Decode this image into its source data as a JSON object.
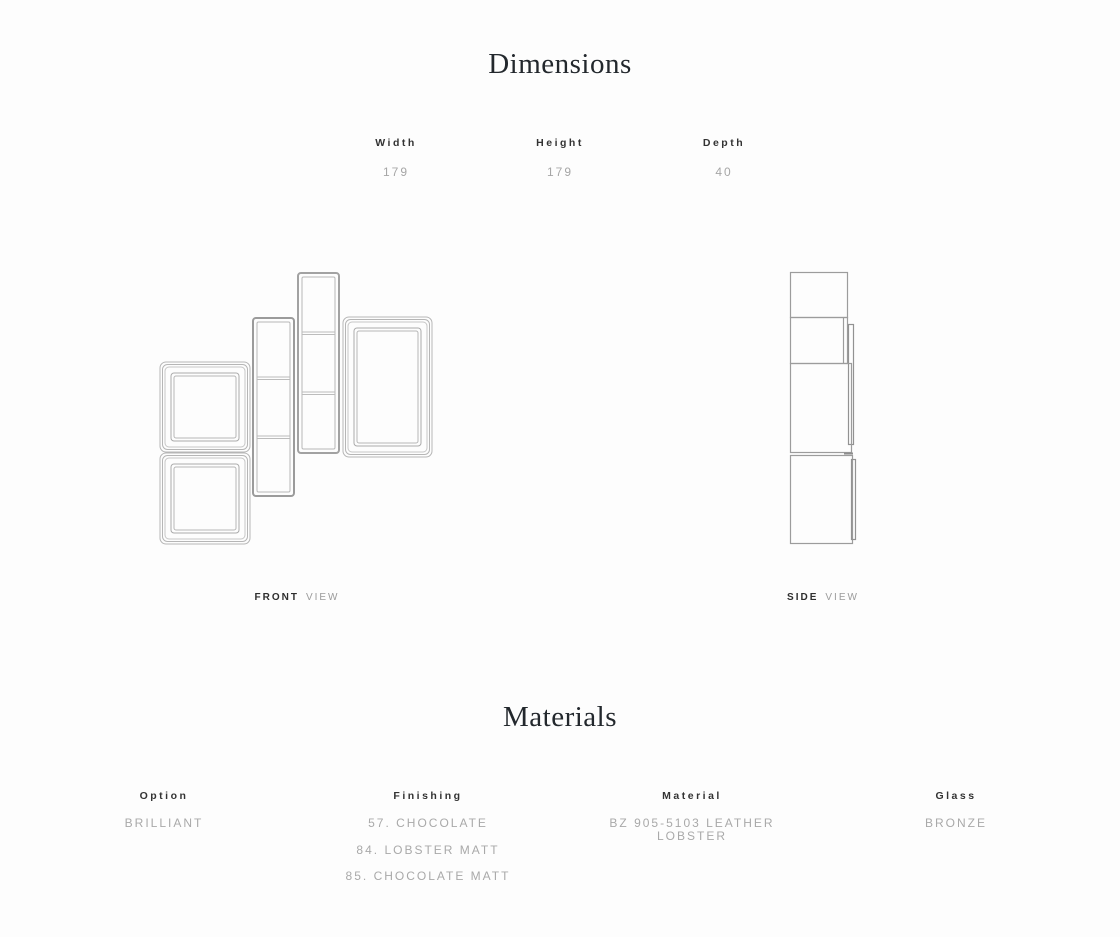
{
  "dimensions_section": {
    "title": "Dimensions",
    "columns": [
      {
        "label": "Width",
        "value": "179"
      },
      {
        "label": "Height",
        "value": "179"
      },
      {
        "label": "Depth",
        "value": "40"
      }
    ],
    "front_view": {
      "label_bold": "FRONT",
      "label_light": "VIEW"
    },
    "side_view": {
      "label_bold": "SIDE",
      "label_light": "VIEW"
    }
  },
  "materials_section": {
    "title": "Materials",
    "columns": [
      {
        "label": "Option",
        "values": [
          "BRILLIANT"
        ]
      },
      {
        "label": "Finishing",
        "values": [
          "57. CHOCOLATE",
          "84. LOBSTER MATT",
          "85. CHOCOLATE MATT"
        ]
      },
      {
        "label": "Material",
        "values": [
          "BZ 905-5103 LEATHER LOBSTER"
        ]
      },
      {
        "label": "Glass",
        "values": [
          "BRONZE"
        ]
      }
    ]
  },
  "colors": {
    "background": "#fdfdfd",
    "heading": "#23282d",
    "label": "#333333",
    "value_muted": "#a6a6a6",
    "drawing_line": "#b4b4b4",
    "drawing_line_dark": "#9c9c9c"
  }
}
